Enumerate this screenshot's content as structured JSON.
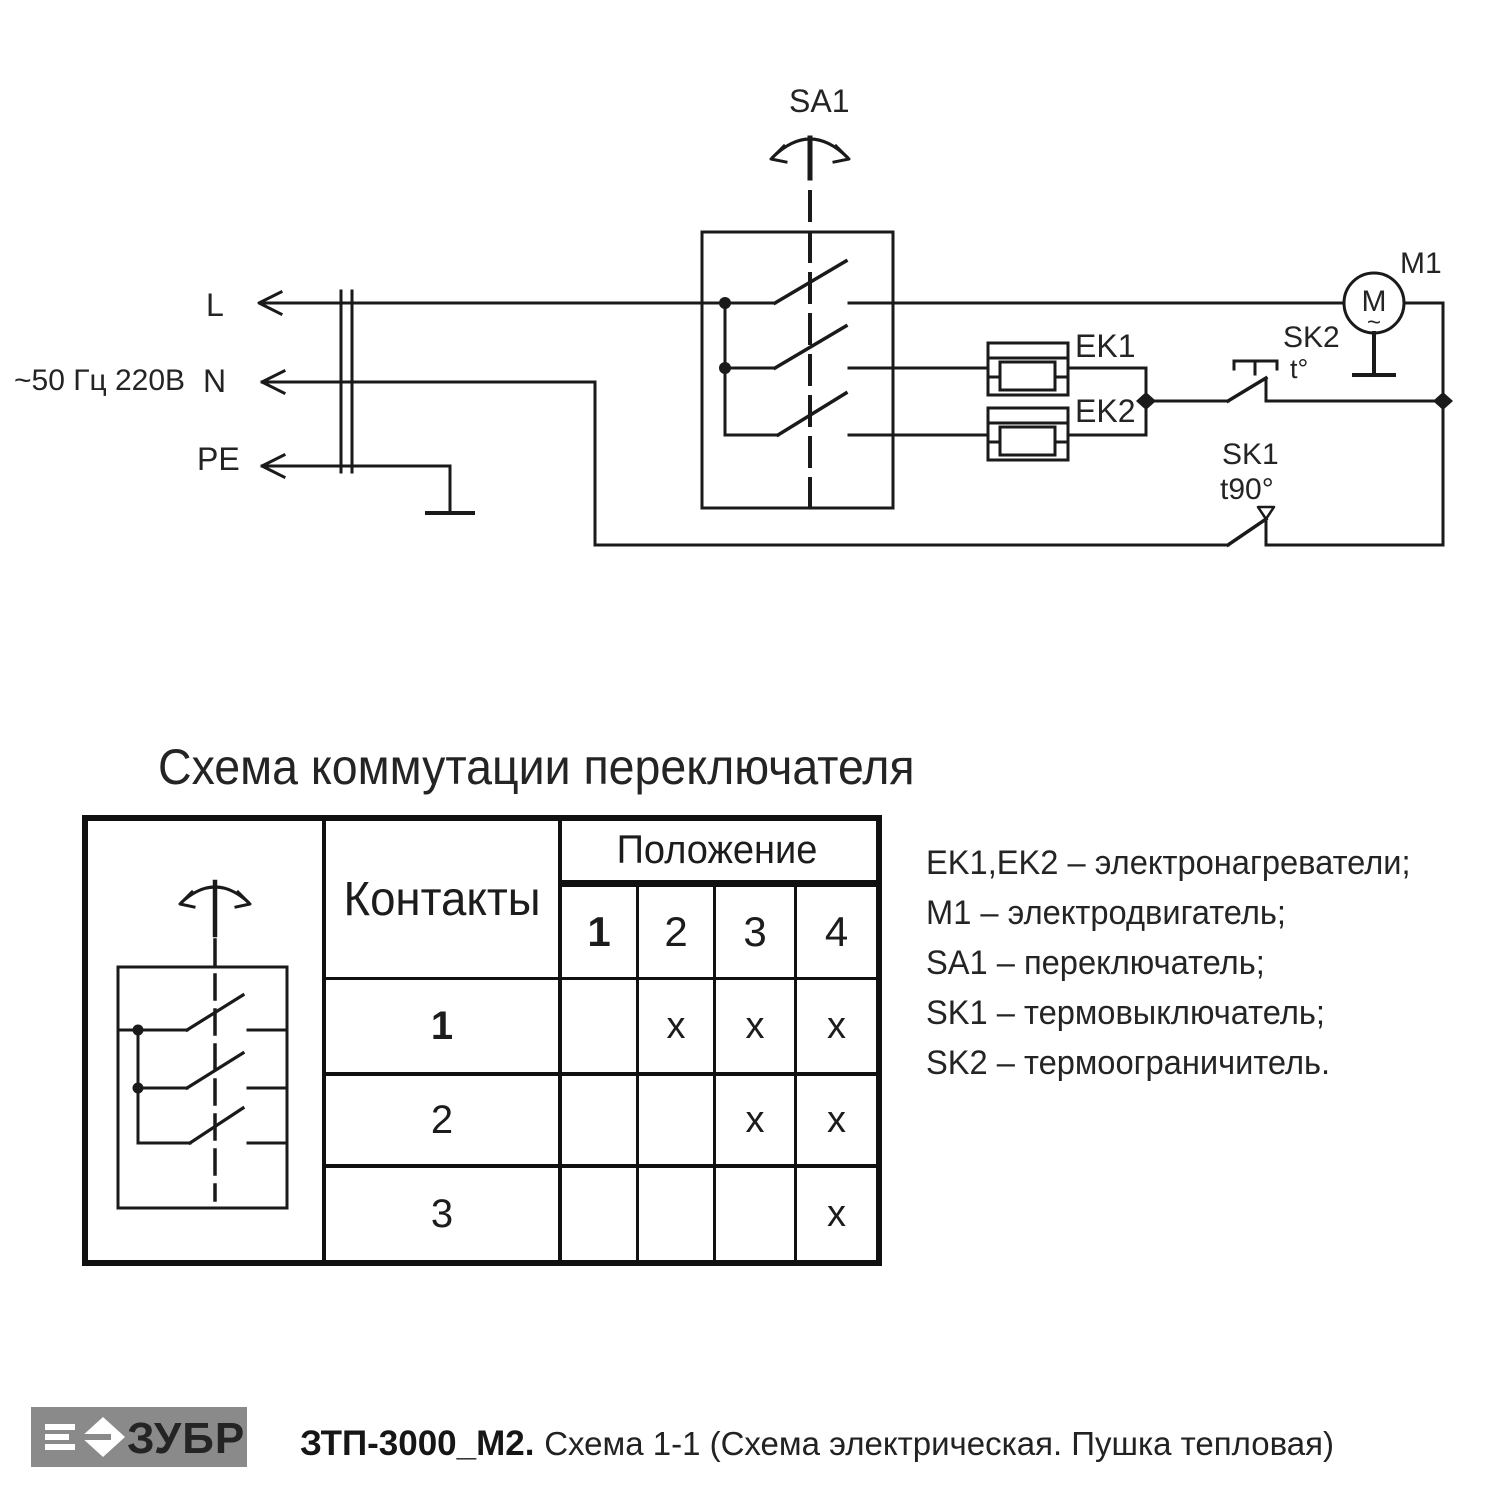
{
  "schematic": {
    "power_label": "~50 Гц 220В",
    "line_l": "L",
    "line_n": "N",
    "line_pe": "PE",
    "switch_label": "SA1",
    "heater1_label": "EK1",
    "heater2_label": "EK2",
    "motor_label": "M1",
    "motor_symbol": "M",
    "motor_wave": "~",
    "thermal_limiter_label": "SK2",
    "thermal_limiter_temp": "t°",
    "thermal_cutout_label": "SK1",
    "thermal_cutout_temp": "t90°"
  },
  "commutation": {
    "title": "Схема коммутации переключателя",
    "contacts_header": "Контакты",
    "position_header": "Положение",
    "position_columns": [
      "1",
      "2",
      "3",
      "4"
    ],
    "rows": [
      {
        "contact": "1",
        "marks": [
          "",
          "x",
          "x",
          "x"
        ]
      },
      {
        "contact": "2",
        "marks": [
          "",
          "",
          "x",
          "x"
        ]
      },
      {
        "contact": "3",
        "marks": [
          "",
          "",
          "",
          "x"
        ]
      }
    ]
  },
  "legend": {
    "items": [
      "EK1,EK2 – электронагреватели;",
      "M1 – электродвигатель;",
      "SA1 – переключатель;",
      "SK1 – термовыключатель;",
      "SK2 – термоограничитель."
    ]
  },
  "footer": {
    "brand": "ЗУБР",
    "model": "ЗТП-3000_М2.",
    "caption": "Схема 1-1 (Схема электрическая. Пушка тепловая)"
  },
  "colors": {
    "line": "#1a1a1a",
    "logo_bg": "#8a8a8a"
  }
}
